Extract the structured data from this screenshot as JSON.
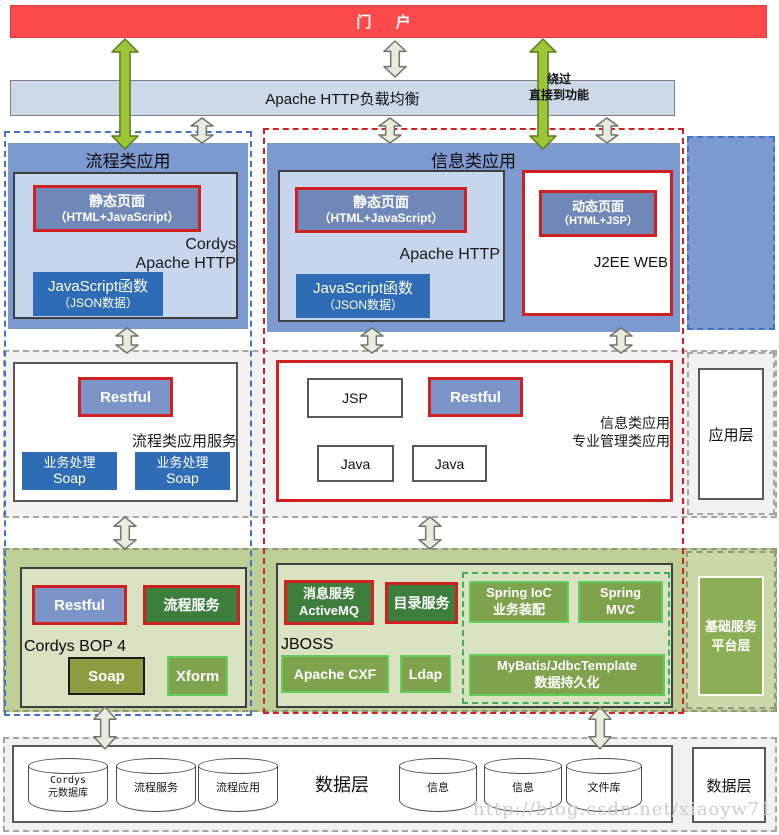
{
  "portal": {
    "label": "门 户"
  },
  "load_balancer": {
    "label": "Apache HTTP负载均衡",
    "bypass_line1": "绕过",
    "bypass_line2": "直接到功能"
  },
  "presentation": {
    "layer_label": "展现层",
    "process_app": {
      "title": "流程类应用",
      "static_page_line1": "静态页面",
      "static_page_line2": "（HTML+JavaScript）",
      "server_line1": "Cordys",
      "server_line2": "Apache HTTP",
      "js_func_line1": "JavaScript函数",
      "js_func_line2": "（JSON数据）"
    },
    "info_app": {
      "title": "信息类应用",
      "static_page_line1": "静态页面",
      "static_page_line2": "（HTML+JavaScript）",
      "server": "Apache HTTP",
      "js_func_line1": "JavaScript函数",
      "js_func_line2": "（JSON数据）",
      "dynamic_page_line1": "动态页面",
      "dynamic_page_line2": "（HTML+JSP）",
      "j2ee_label": "J2EE WEB"
    }
  },
  "application": {
    "layer_label": "应用层",
    "process_service": {
      "restful": "Restful",
      "caption": "流程类应用服务",
      "soap1_line1": "业务处理",
      "soap1_line2": "Soap",
      "soap2_line1": "业务处理",
      "soap2_line2": "Soap"
    },
    "info_service": {
      "jsp": "JSP",
      "restful": "Restful",
      "java1": "Java",
      "java2": "Java",
      "caption_line1": "信息类应用",
      "caption_line2": "专业管理类应用"
    }
  },
  "platform": {
    "layer_label_line1": "基础服务",
    "layer_label_line2": "平台层",
    "cordys": {
      "restful": "Restful",
      "process_service": "流程服务",
      "title": "Cordys BOP 4",
      "soap": "Soap",
      "xform": "Xform"
    },
    "jboss": {
      "title": "JBOSS",
      "mq_line1": "消息服务",
      "mq_line2": "ActiveMQ",
      "directory": "目录服务",
      "cxf": "Apache CXF",
      "ldap": "Ldap",
      "spring_ioc_line1": "Spring IoC",
      "spring_ioc_line2": "业务装配",
      "spring_mvc_line1": "Spring",
      "spring_mvc_line2": "MVC",
      "mybatis_line1": "MyBatis/JdbcTemplate",
      "mybatis_line2": "数据持久化"
    }
  },
  "data_layer": {
    "inline_label": "数据层",
    "layer_label": "数据层",
    "databases": [
      {
        "line1": "Cordys",
        "line2": "元数据库"
      },
      {
        "line1": "流程服务",
        "line2": ""
      },
      {
        "line1": "流程应用",
        "line2": ""
      },
      {
        "line1": "信息",
        "line2": ""
      },
      {
        "line1": "信息",
        "line2": ""
      },
      {
        "line1": "文件库",
        "line2": ""
      }
    ]
  },
  "watermark": "http://blog.csdn.net/xiaoyw71",
  "colors": {
    "portal_red": "#FA4A4C",
    "bar_blue": "#CDD9E9",
    "band_blue": "#7C9AD0",
    "inner_blue": "#C7D6EC",
    "steel_blue": "#6F88B8",
    "strong_blue": "#2E6DB5",
    "label_blue": "#2F6CC0",
    "red_border": "#D02020",
    "band_green": "#BDCF97",
    "inner_green": "#D9E3C1",
    "dark_green": "#3E7E3C",
    "mid_green": "#7FA24C",
    "olive": "#8E9D42",
    "light_green_border": "#5FCE5F",
    "arrow_beige": "#EAEBDF",
    "arrow_green": "#9CC636"
  }
}
